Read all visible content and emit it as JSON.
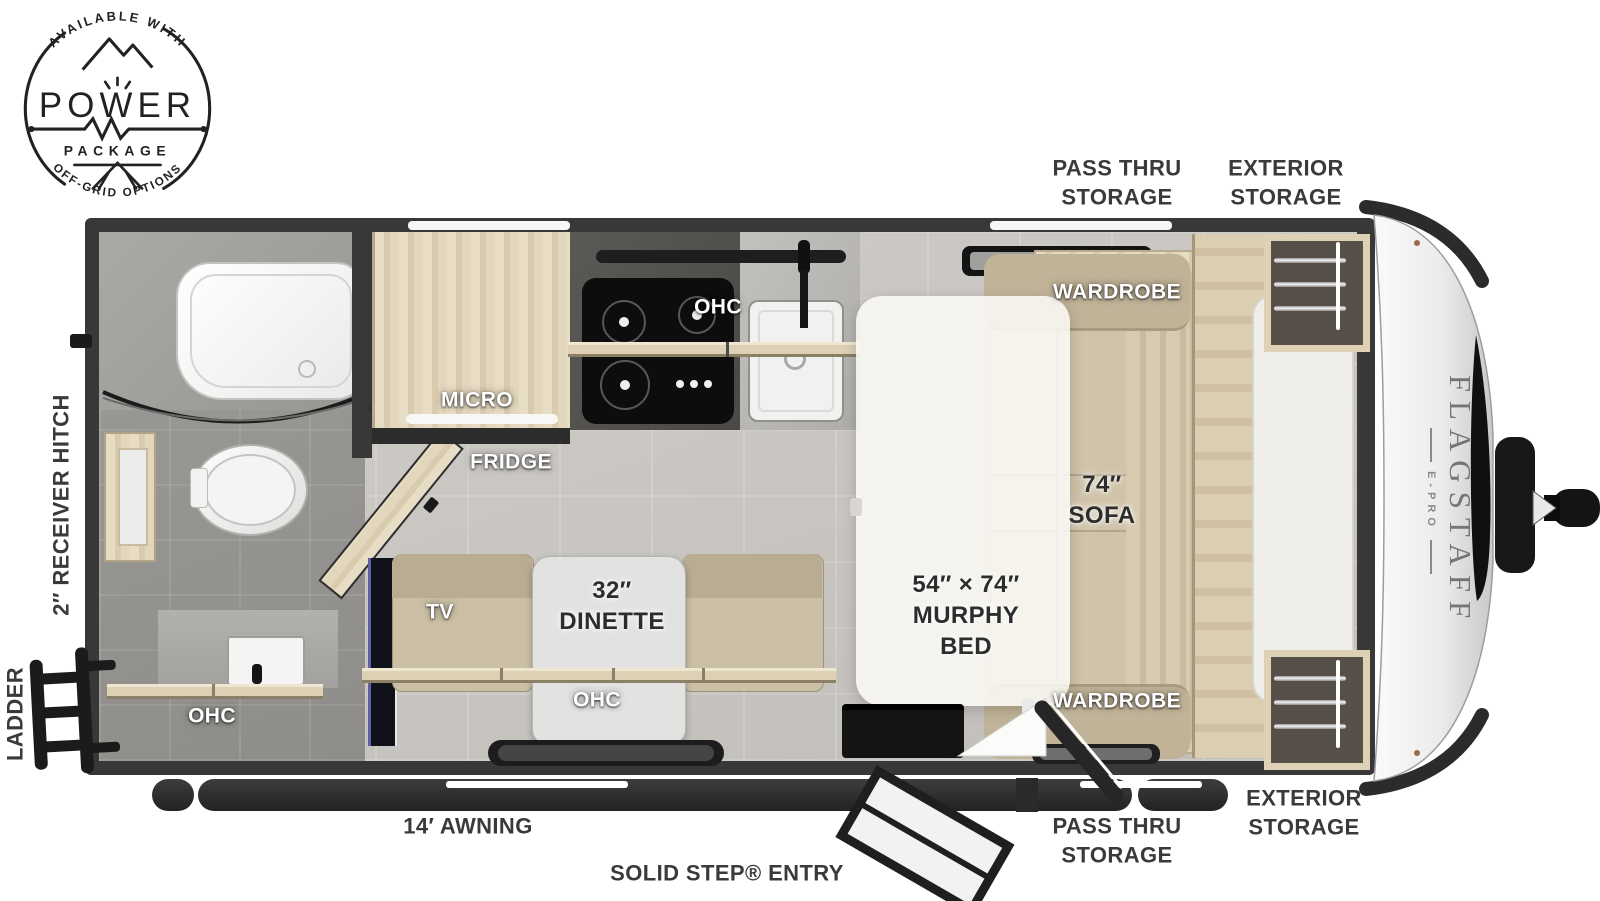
{
  "badge": {
    "arcTop": "AVAILABLE WITH",
    "word": "POWER",
    "sub": "PACKAGE",
    "arcBottom": "OFF-GRID OPTIONS"
  },
  "brand": {
    "name": "FLAGSTAFF",
    "model": "E-PRO"
  },
  "labels": {
    "passThruTop": "PASS THRU\nSTORAGE",
    "exteriorTop": "EXTERIOR\nSTORAGE",
    "receiverHitch": "2″ RECEIVER HITCH",
    "ladder": "LADDER",
    "awning": "14′ AWNING",
    "entry": "SOLID STEP® ENTRY",
    "passThruBottom": "PASS THRU\nSTORAGE",
    "exteriorBottom": "EXTERIOR\nSTORAGE",
    "wardrobeTop": "WARDROBE",
    "wardrobeBottom": "WARDROBE",
    "ohcKitchen": "OHC",
    "ohcDinette": "OHC",
    "ohcBath": "OHC",
    "micro": "MICRO",
    "fridge": "FRIDGE",
    "tv": "TV",
    "dinette": "32″\nDINETTE",
    "sofa": "74″\nSOFA",
    "murphyBed": "54″ × 74″\nMURPHY\nBED"
  },
  "colors": {
    "wall": "#383838",
    "floor": "#c8c5c0",
    "floorBath": "#969592",
    "wood": "#ddd0b5",
    "fabric": "#cbbfa6",
    "mattress": "#f0eee8",
    "labelDark": "#3a3a3a",
    "ink": "#2d2d2d"
  }
}
